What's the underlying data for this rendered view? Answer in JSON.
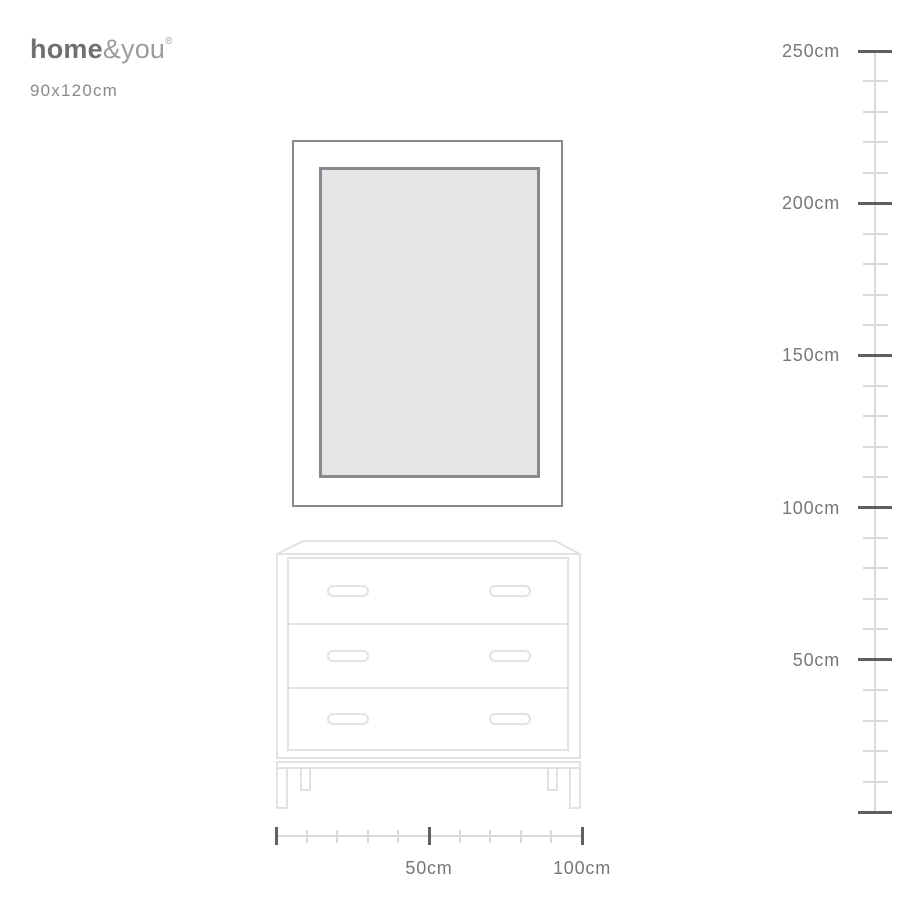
{
  "brand": {
    "logo_bold": "home",
    "logo_light": "&you",
    "registered_mark": "®"
  },
  "product": {
    "size_label": "90x120cm"
  },
  "vertical_ruler": {
    "unit": "cm",
    "min_value": 0,
    "max_value": 250,
    "major_step": 50,
    "minor_step": 10,
    "labels": [
      {
        "value": 250,
        "text": "250cm"
      },
      {
        "value": 200,
        "text": "200cm"
      },
      {
        "value": 150,
        "text": "150cm"
      },
      {
        "value": 100,
        "text": "100cm"
      },
      {
        "value": 50,
        "text": "50cm"
      }
    ]
  },
  "horizontal_ruler": {
    "unit": "cm",
    "min_value": 0,
    "max_value": 100,
    "major_step": 50,
    "minor_step": 10,
    "labels": [
      {
        "value": 50,
        "text": "50cm"
      },
      {
        "value": 100,
        "text": "100cm"
      }
    ]
  },
  "colors": {
    "background": "#ffffff",
    "label_text": "#76777b",
    "brand_bold": "#6f7073",
    "brand_light": "#9b9ca0",
    "size_text": "#898a8e",
    "tick_dark": "#5f6064",
    "tick_light": "#d9d9db",
    "ruler_line": "#d9d9db",
    "frame_border": "#88898c",
    "frame_fill": "#e5e5e7",
    "furniture_line": "#e2e2e4"
  }
}
